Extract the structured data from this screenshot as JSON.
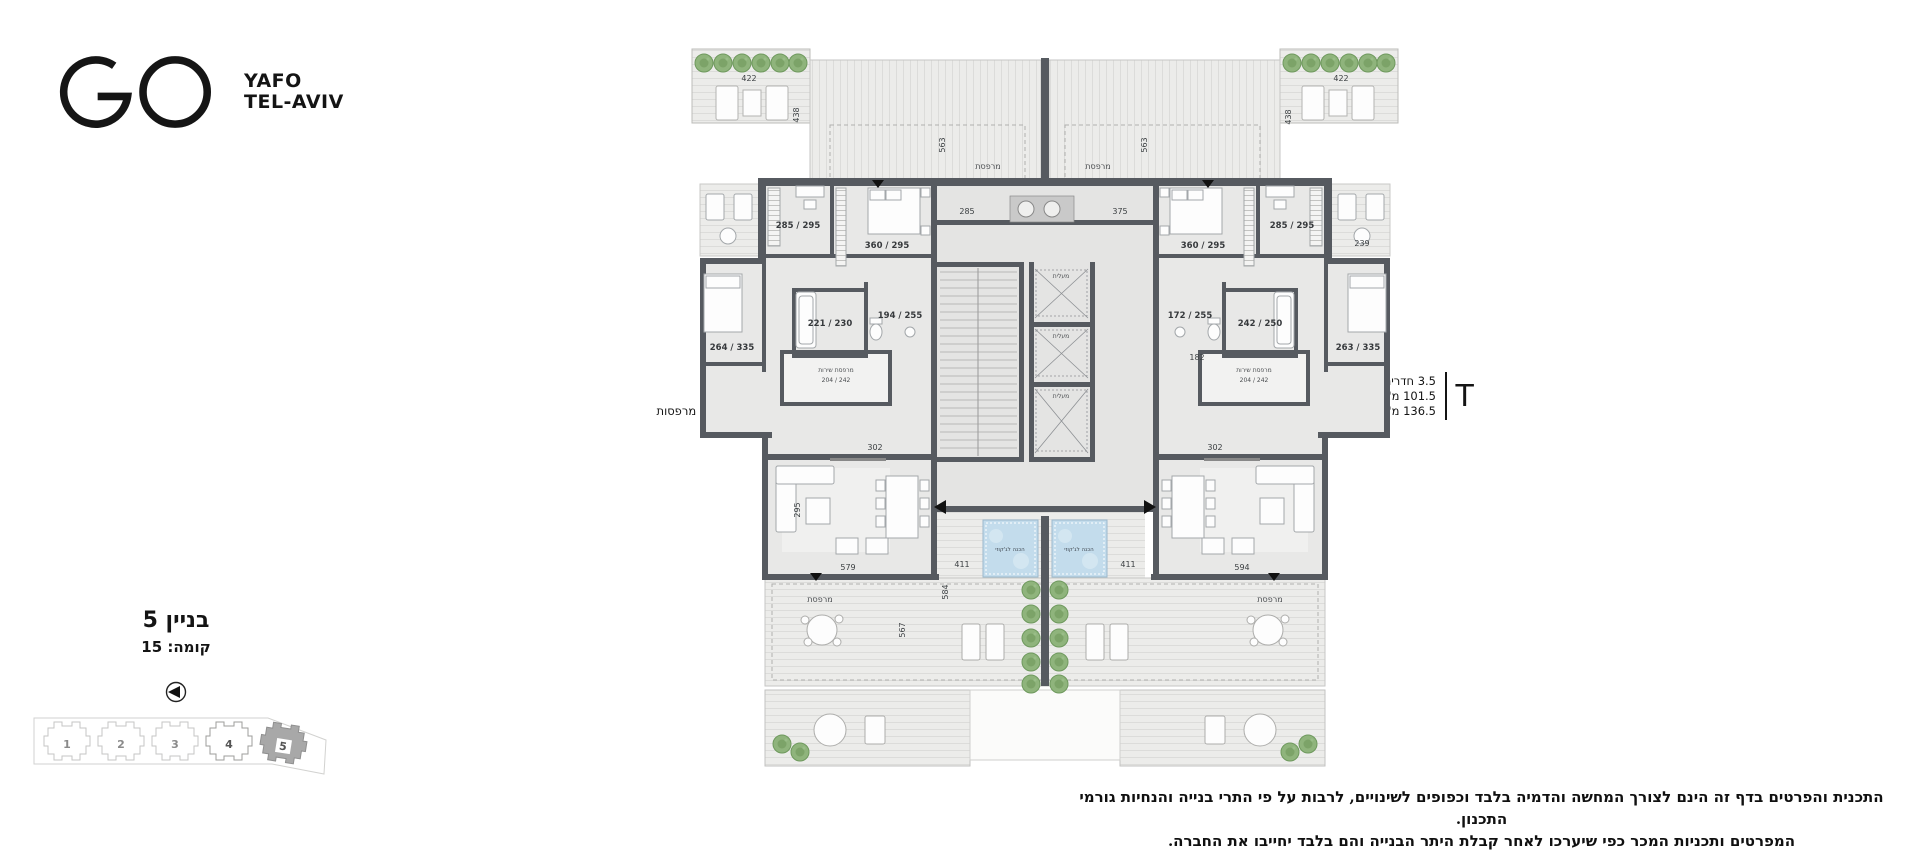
{
  "brand": {
    "line1": "YAFO",
    "line2": "TEL-AVIV"
  },
  "apartments": {
    "s": {
      "letter": "S",
      "rooms": "3.5 חדרים",
      "area": "101 מ\"ר",
      "terrace": "138.5 מ\"ר מרפסות"
    },
    "t": {
      "letter": "T",
      "rooms": "3.5 חדרים",
      "area": "101.5 מ\"ר",
      "terrace": "136.5 מ\"ר מרפסות"
    }
  },
  "building_info": {
    "building": "בניין 5",
    "floor": "קומה: 15"
  },
  "site_plan": {
    "buildings": [
      "1",
      "2",
      "3",
      "4",
      "5"
    ],
    "highlighted": "5"
  },
  "disclaimer": {
    "line1": "התכנית והפרטים בדף זה הינם לצורך המחשה והדמיה בלבד וכפופים לשינויים, לרבות על פי התרי בנייה והנחיות גורמי התכנון.",
    "line2": "המפרטים ותכניות המכר כפי שיערכו לאחר קבלת היתר הבנייה והם בלבד יחייבו את החברה."
  },
  "plan": {
    "labels": {
      "terrace": "מרפסת",
      "service_balcony": "מרפסת שירות",
      "elevator": "מעלית",
      "jacuzzi": "הכנה לג'קוזי"
    },
    "dims": {
      "service": "204 / 242",
      "a1": "285 / 295",
      "a2": "360 / 295",
      "a3": "194 / 255",
      "a4": "221 / 230",
      "a5": "264 / 335",
      "b1": "285 / 295",
      "b2": "360 / 295",
      "b3": "172 / 255",
      "b4": "242 / 250",
      "b5": "263 / 335",
      "living_l": "579",
      "living_r": "594",
      "d411": "411",
      "d302": "302",
      "d295": "295",
      "d285": "285",
      "d375": "375",
      "d422": "422",
      "d438": "438",
      "d563": "563",
      "d567": "567",
      "d584": "584",
      "d239": "239",
      "d182": "182"
    }
  },
  "colors": {
    "wall": "#565a60",
    "tree": "#8fb47c",
    "pool": "#c3dcec",
    "highlight": "#a8a8a8"
  }
}
